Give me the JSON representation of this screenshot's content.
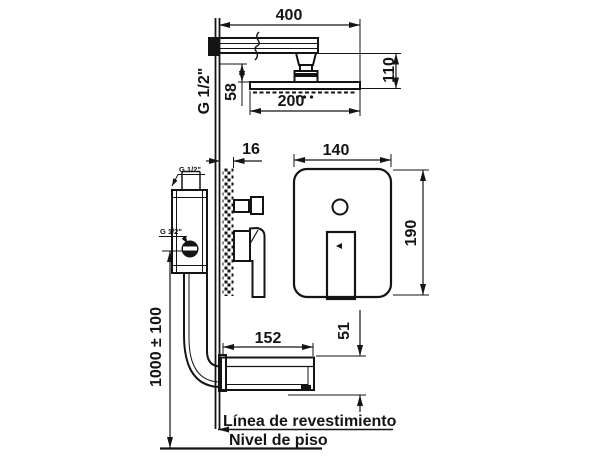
{
  "drawing": {
    "dimensions": {
      "arm_length": "400",
      "head_drop": "110",
      "head_width": "200",
      "arm_clearance": "58",
      "arm_thread": "G 1/2\"",
      "finish_thickness": "16",
      "plate_width": "140",
      "plate_height": "190",
      "valve_top_thread": "G 1/2\"",
      "valve_inlet_thread": "G 1/2\"",
      "spout_length": "152",
      "spout_height": "51",
      "valve_install_height": "1000 ± 100"
    },
    "labels": {
      "finish_line": "Línea de revestimiento",
      "floor_line": "Nivel de piso"
    }
  }
}
